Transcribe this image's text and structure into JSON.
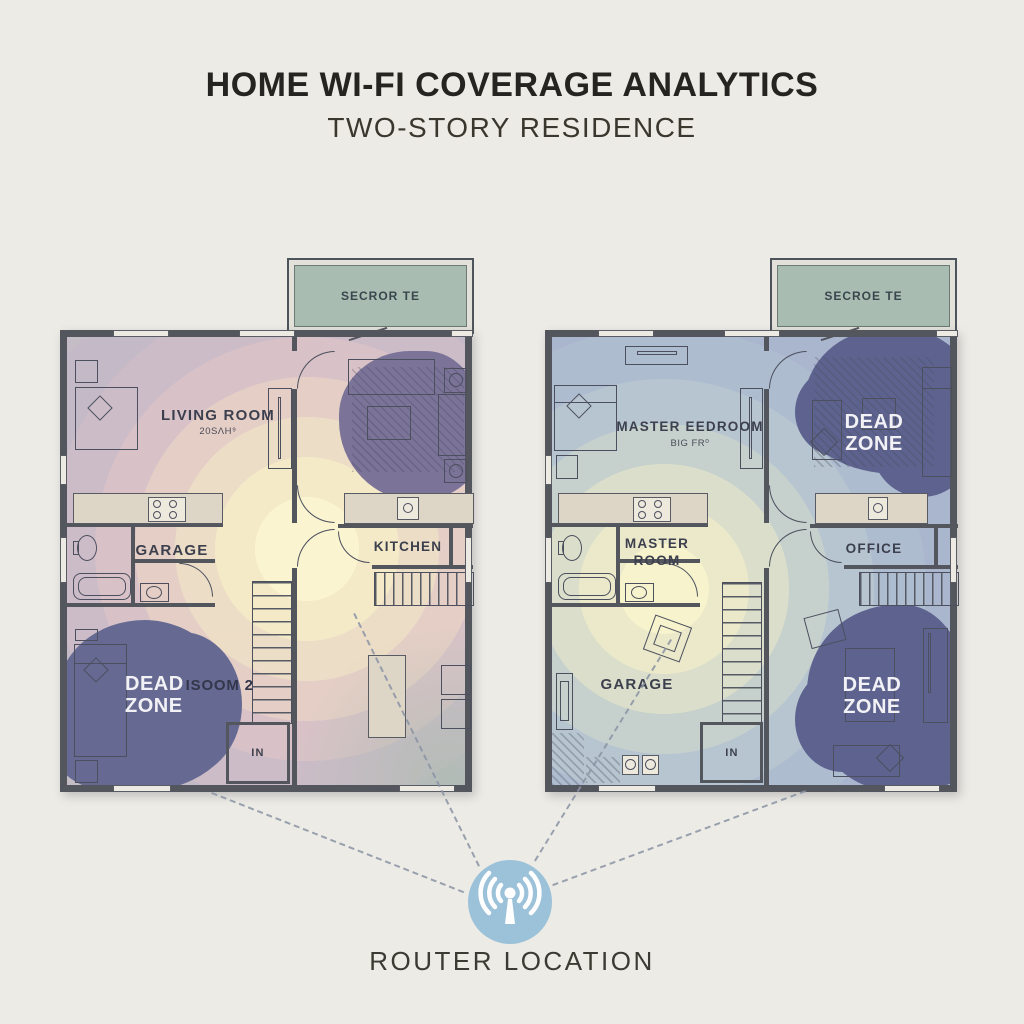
{
  "header": {
    "title": "HOME WI-FI COVERAGE ANALYTICS",
    "subtitle": "TWO-STORY RESIDENCE"
  },
  "floor1": {
    "porch_label": "SECROR TE",
    "living_room": {
      "name": "LIVING ROOM",
      "area": "20SΛH⁹"
    },
    "garage": "GARAGE",
    "kitchen": "KITCHEN",
    "entry": "IN",
    "dead_zone": {
      "line1": "DEAD",
      "line2": "ZONE",
      "overlap_text": "ISOOM 2"
    }
  },
  "floor2": {
    "porch_label": "SECROE TE",
    "master_bedroom": {
      "name": "MASTER EEDROOM",
      "area": "BIG FR⁰"
    },
    "master_room": {
      "line1": "MASTER",
      "line2": "ROOM"
    },
    "office": "OFFICE",
    "garage": "GARAGE",
    "entry": "IN",
    "dead_zone_top": {
      "line1": "DEAD",
      "line2": "ZONE"
    },
    "dead_zone_bottom": {
      "line1": "DEAD",
      "line2": "ZONE"
    }
  },
  "router": {
    "label": "ROUTER LOCATION",
    "icon": "wifi-antenna-icon",
    "accent_color": "#9cc2da"
  },
  "legend_colors": {
    "strong_signal": "#f9f1cc",
    "medium_signal": "#cfd8d2",
    "weak_signal": "#aab6d0",
    "dead_zone": "#62668f",
    "porch": "#a8bcb1",
    "background": "#edebe5"
  }
}
